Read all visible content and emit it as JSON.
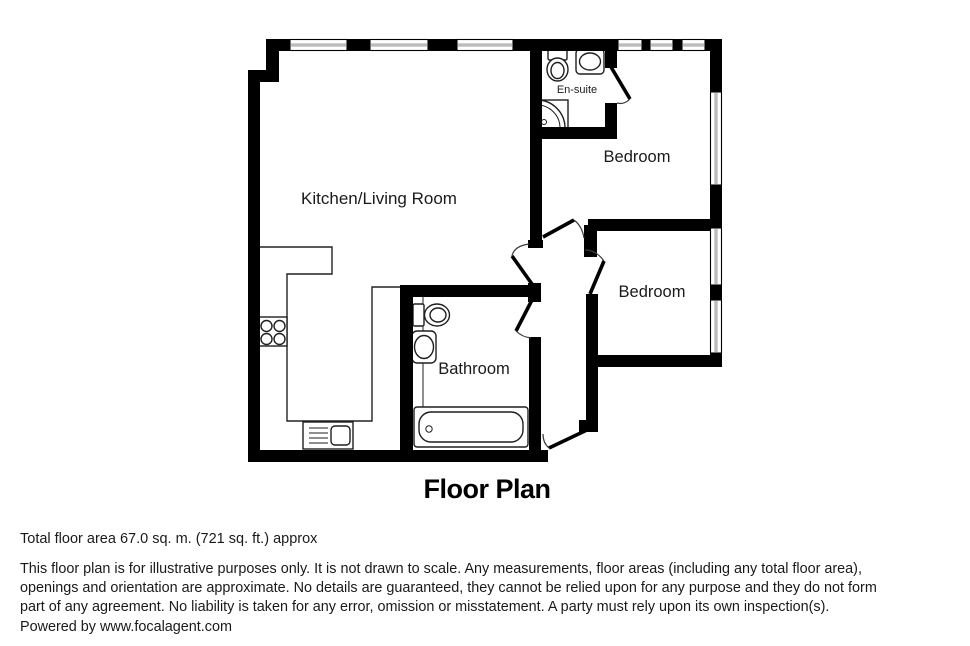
{
  "title": "Floor Plan",
  "colors": {
    "wall": "#000000",
    "window_glass": "#bcbcbc",
    "fixture_stroke": "#1f1f1f",
    "text": "#1a1a1a"
  },
  "rooms": {
    "kitchen_living": {
      "label": "Kitchen/Living Room"
    },
    "ensuite": {
      "label": "En-suite"
    },
    "bedroom_1": {
      "label": "Bedroom"
    },
    "bedroom_2": {
      "label": "Bedroom"
    },
    "bathroom": {
      "label": "Bathroom"
    }
  },
  "footer": {
    "area_line": "Total floor area 67.0 sq. m. (721 sq. ft.) approx",
    "disclaimer_lines": [
      "This floor plan is for illustrative purposes only. It is not drawn to scale. Any measurements, floor areas (including any total floor area),",
      "openings and orientation are approximate. No details are guaranteed, they cannot be relied upon for any purpose and they do not form",
      "part of any agreement. No liability is taken for any error, omission or misstatement. A party must rely upon its own inspection(s).",
      "Powered by www.focalagent.com"
    ]
  }
}
